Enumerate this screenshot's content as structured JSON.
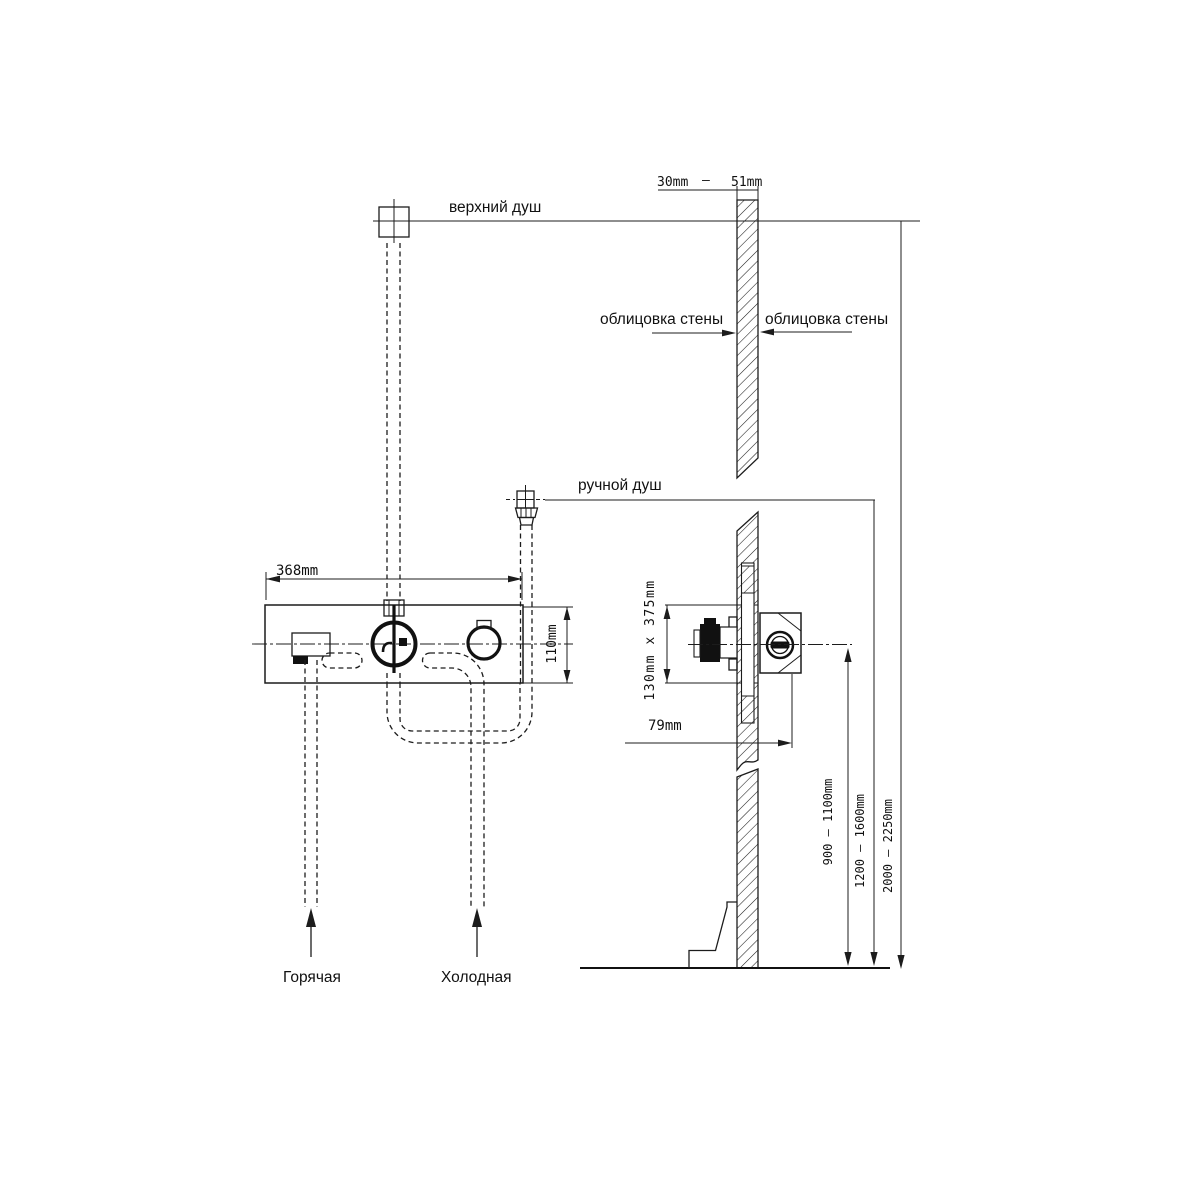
{
  "drawing": {
    "labels": {
      "top_shower": "верхний душ",
      "hand_shower": "ручной душ",
      "wall_cladding_left": "облицовка стены",
      "wall_cladding_right": "облицовка стены",
      "hot_supply": "Горячая",
      "cold_supply": "Холодная"
    },
    "dimensions": {
      "wall_thickness_min": "30mm",
      "wall_thickness_sep": "—",
      "wall_thickness_max": "51mm",
      "panel_width": "368mm",
      "panel_height": "110mm",
      "rough_in_size": "130mm x 375mm",
      "valve_depth": "79mm",
      "valve_height_range": "900 — 1100mm",
      "hand_shower_height_range": "1200 — 1600mm",
      "top_shower_height_range": "2000 — 2250mm"
    },
    "line_color": "#1c1c1c",
    "background": "#ffffff"
  }
}
